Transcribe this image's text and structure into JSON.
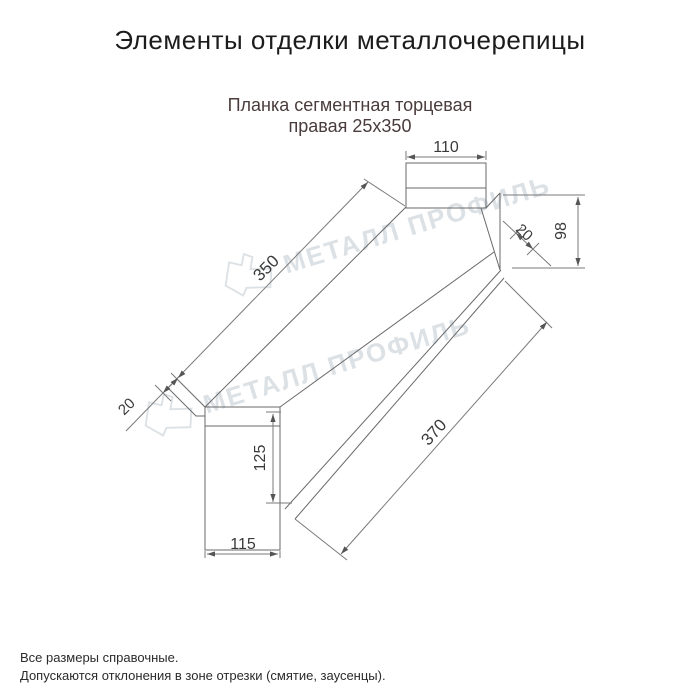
{
  "header": {
    "title": "Элементы отделки металлочерепицы"
  },
  "product": {
    "name_line1": "Планка сегментная торцевая",
    "name_line2": "правая 25x350"
  },
  "watermark": {
    "text": "МЕТАЛЛ ПРОФИЛЬ"
  },
  "drawing": {
    "dims": {
      "top_width": "110",
      "face_length": "350",
      "right_hem": "20",
      "right_height": "98",
      "bottom_length": "370",
      "left_hem": "20",
      "end_height": "125",
      "end_width": "115"
    }
  },
  "footer": {
    "note1": "Все размеры справочные.",
    "note2": "Допускаются отклонения в зоне отрезки (смятие, заусенцы)."
  },
  "colors": {
    "title": "#1c1c1c",
    "subtitle": "#4a3c3c",
    "watermark": "#dce1e5",
    "drawing_line": "#6a6a6a"
  }
}
